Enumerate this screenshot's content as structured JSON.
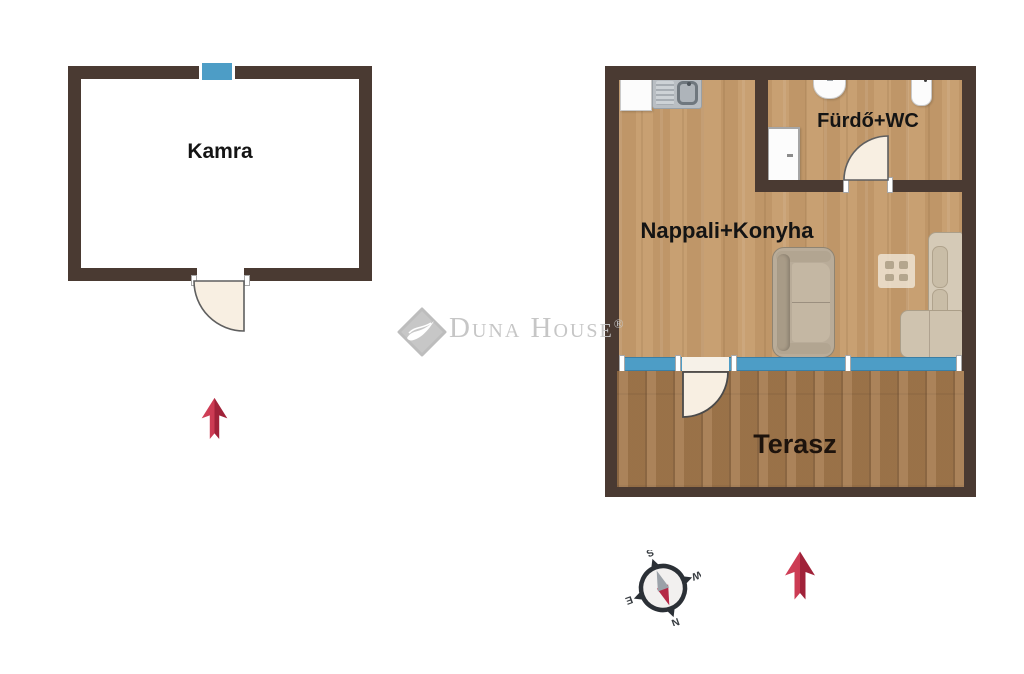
{
  "floorplan": {
    "rooms": {
      "kamra": {
        "label": "Kamra"
      },
      "living": {
        "label": "Nappali+Konyha"
      },
      "bathroom": {
        "label": "Fürdő+WC"
      },
      "terrace": {
        "label": "Terasz"
      }
    },
    "watermark": {
      "brand": "Duna House",
      "registered": "®"
    },
    "compass": {
      "north": "N",
      "south": "S",
      "east": "E",
      "west": "W",
      "rotation_deg": 160
    },
    "colors": {
      "wall": "#4a3a32",
      "window_blue": "#4d9dc6",
      "living_floor": "#c69c6c",
      "terrace_floor": "#a57a4e",
      "door_leaf": "#f8efe2",
      "arrow_red_light": "#d04058",
      "arrow_red_dark": "#a02239",
      "watermark_gray": "#c6c6c6",
      "label_text": "#141414"
    }
  }
}
